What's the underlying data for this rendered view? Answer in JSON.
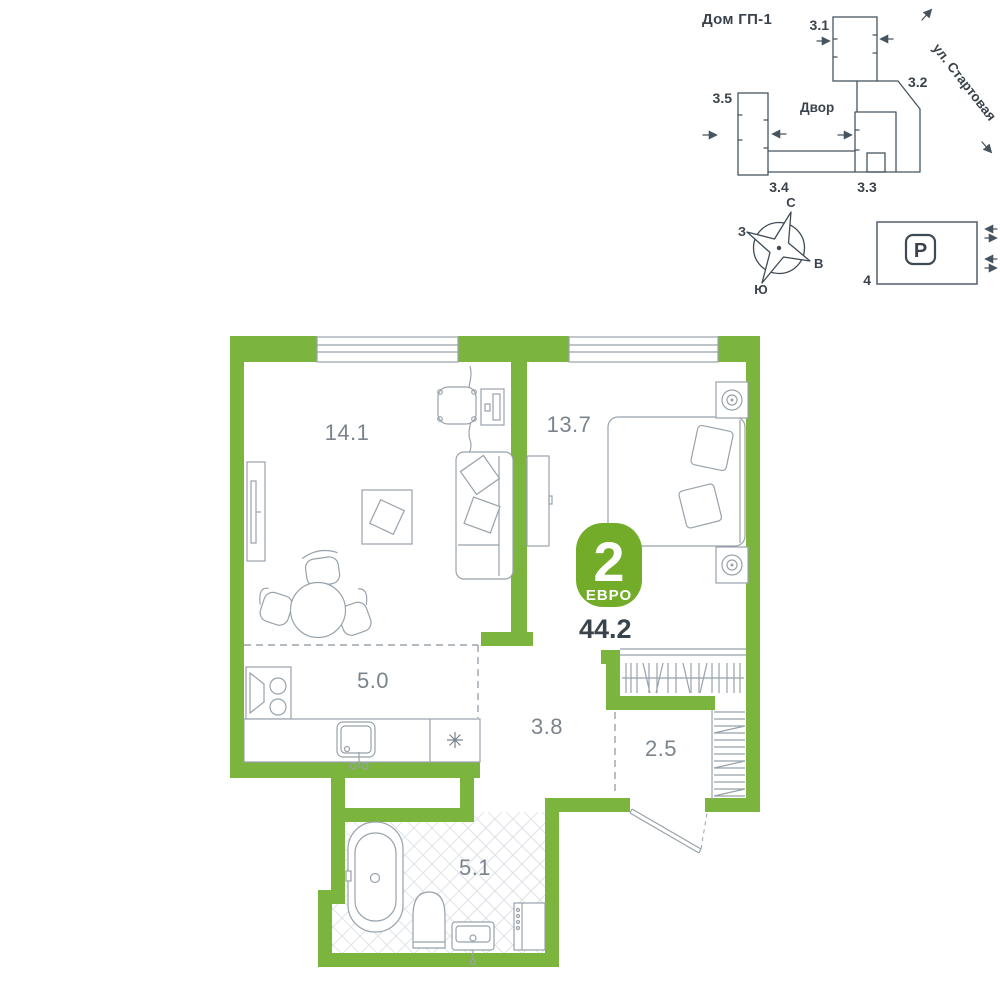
{
  "colors": {
    "wall_green": "#7cb53e",
    "badge_green": "#72ac28",
    "furniture_line": "#98a2ab",
    "site_line": "#46545f",
    "text_dark": "#3a434b",
    "room_label": "#7b848d",
    "tile_line": "#e1e5e9"
  },
  "site_plan": {
    "title": "Дом ГП-1",
    "courtyard_label": "Двор",
    "street_label": "ул. Стартовая",
    "buildings": {
      "b31": "3.1",
      "b32": "3.2",
      "b33": "3.3",
      "b34": "3.4",
      "b35": "3.5"
    }
  },
  "compass": {
    "north": "С",
    "west": "З",
    "east": "В",
    "south": "Ю"
  },
  "parking": {
    "symbol": "P",
    "label": "4"
  },
  "apartment": {
    "type_rooms": "2",
    "type_label": "ЕВРО",
    "total_area": "44.2",
    "rooms": {
      "living": "14.1",
      "bedroom": "13.7",
      "kitchen": "5.0",
      "hallway": "3.8",
      "wardrobe": "2.5",
      "bathroom": "5.1"
    }
  }
}
